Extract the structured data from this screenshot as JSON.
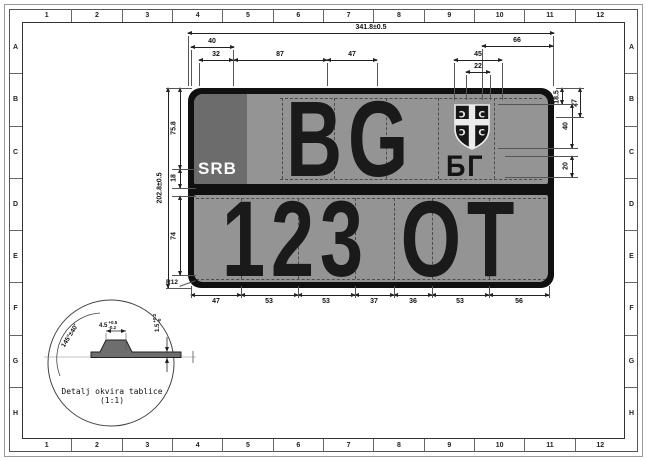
{
  "sheet": {
    "top_ruler": [
      "1",
      "2",
      "3",
      "4",
      "5",
      "6",
      "7",
      "8",
      "9",
      "10",
      "11",
      "12"
    ],
    "bottom_ruler": [
      "1",
      "2",
      "3",
      "4",
      "5",
      "6",
      "7",
      "8",
      "9",
      "10",
      "11",
      "12"
    ],
    "left_ruler": [
      "A",
      "B",
      "C",
      "D",
      "E",
      "F",
      "G",
      "H"
    ],
    "right_ruler": [
      "A",
      "B",
      "C",
      "D",
      "E",
      "F",
      "G",
      "H"
    ]
  },
  "plate": {
    "country_code": "SRB",
    "registration_top": "BG",
    "registration_bottom_digits": "123",
    "registration_bottom_letters": "OT",
    "district_cyrillic": "БГ",
    "emblem": "serbian-cross-shield",
    "firesteel_left": "Ɔ",
    "firesteel_right": "C"
  },
  "colors": {
    "plate_field": "#949494",
    "country_band": "#6c6c6c",
    "frame": "#101010",
    "drawing_line": "#222222"
  },
  "dimensions": {
    "width_total": "341.8±0.5",
    "height_total": "202.8±0.5",
    "t40": "40",
    "t32": "32",
    "t87": "87",
    "t47": "47",
    "t66": "66",
    "t45": "45",
    "t22": "22",
    "r185": "18.5",
    "r27": "27",
    "r40": "40",
    "r20": "20",
    "l758": "75.8",
    "l18": "18",
    "l74": "74",
    "bottom": [
      "47",
      "53",
      "53",
      "37",
      "36",
      "53",
      "56"
    ],
    "radius": "R12"
  },
  "detail": {
    "caption": "Detalj okvira tablice (1:1)",
    "angle": "145°±40′",
    "width_nominal": "4.5",
    "width_plus": "+0.5",
    "width_minus": "-0.2",
    "thickness_nominal": "1.5",
    "thickness_plus": "+0.2",
    "thickness_minus": "-0"
  }
}
